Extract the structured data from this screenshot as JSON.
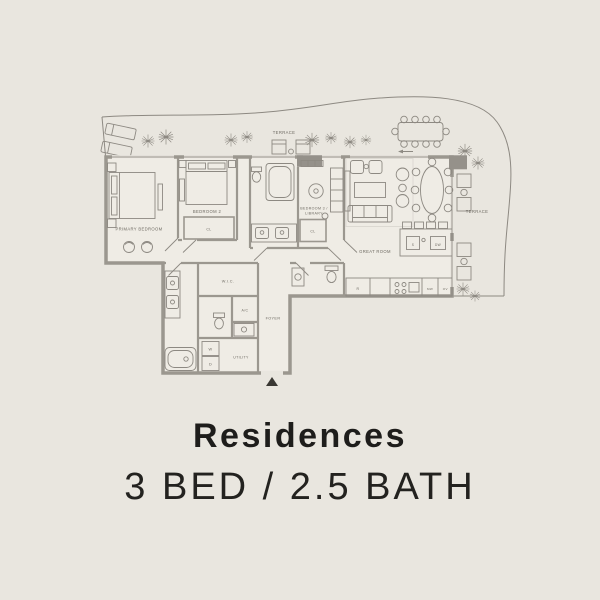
{
  "background_color": "#e9e6df",
  "caption": {
    "title": "Residences",
    "subtitle": "3 BED / 2.5 BATH"
  },
  "plan": {
    "labels": {
      "terrace_top": "TERRACE",
      "terrace_right": "TERRACE",
      "primary_bedroom": "PRIMARY BEDROOM",
      "bedroom_2": "BEDROOM 2",
      "bedroom_3_line1": "BEDROOM 3 /",
      "bedroom_3_line2": "LIBRARY",
      "great_room": "GREAT ROOM",
      "foyer": "FOYER",
      "wic": "W.I.C.",
      "ac": "A/C",
      "utility": "UTILITY",
      "closet": "CL",
      "washer": "W",
      "dryer": "D",
      "refrigerator": "R",
      "microwave": "MW",
      "oven": "OV",
      "dishwasher": "DW",
      "island_sink": "S"
    },
    "colors": {
      "wall": "#9b978f",
      "line": "#8d8982",
      "floor": "#efece5",
      "label": "#6e6a62",
      "title_text": "#1e1d1b"
    }
  }
}
